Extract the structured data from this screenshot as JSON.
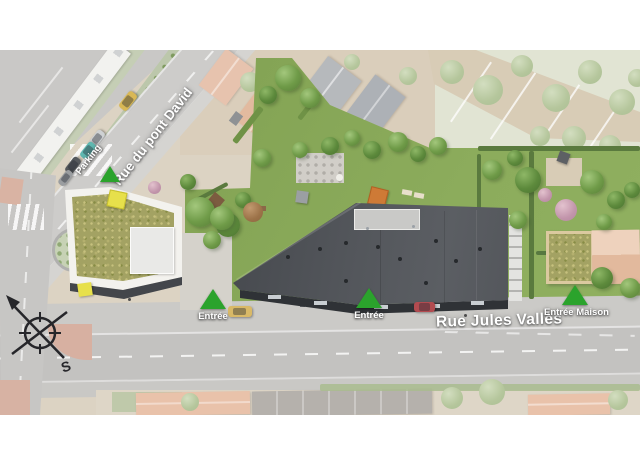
{
  "plan": {
    "streets": {
      "diagonal": "Rue du pont David",
      "horizontal": "Rue Jules Vallès"
    },
    "markers": {
      "parking": "Parking",
      "entree_left": "Entrée",
      "entree_center": "Entrée",
      "entree_maison": "Entrée Maison"
    },
    "compass": {
      "south": "S"
    },
    "colors": {
      "marker_green": "#2ba32c",
      "main_roof": "#54575c",
      "lawn": "#87a757",
      "green_roof": "#a3a263",
      "road": "#c6c5c3",
      "background": "#ffffff"
    }
  }
}
